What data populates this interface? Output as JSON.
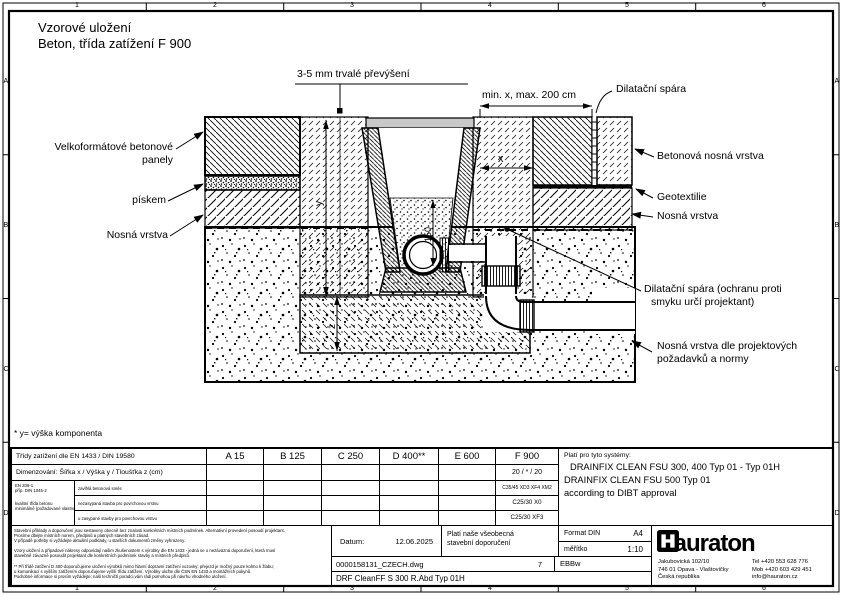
{
  "page": {
    "title_line1": "Vzorové uložení",
    "title_line2": "Beton, třída zatížení F 900",
    "footnote": "* y= výška komponenta"
  },
  "ruler": {
    "cols": [
      "1",
      "2",
      "3",
      "4",
      "5",
      "6"
    ],
    "rows": [
      "A",
      "B",
      "C",
      "D"
    ]
  },
  "drawing": {
    "annotations": {
      "overhang": "3-5 mm trvalé převýšení",
      "min_max": "min. x, max. 200 cm",
      "dilatation_top": "Dilatační spára",
      "panels_line1": "Velkoformátové betonové",
      "panels_line2": "panely",
      "sand": "pískem",
      "base_layer_left": "Nosná vrstva",
      "concrete_base": "Betonová nosná vrstva",
      "geotextile": "Geotextilie",
      "base_layer_right": "Nosná vrstva",
      "dilatation_lower_line1": "Dilatační spára (ochranu proti",
      "dilatation_lower_line2": "smyku určí projektant)",
      "base_req_line1": "Nosná vrstva dle projektových",
      "base_req_line2": "požadavků a normy",
      "dim_x": "x",
      "dim_y": "y",
      "dim_z": "z",
      "dim_150": "150"
    }
  },
  "table": {
    "load_class_row_label": "Třídy zatížení dle EN 1433 / DIN 19580",
    "load_classes": [
      "A 15",
      "B 125",
      "C 250",
      "D 400**",
      "E 600",
      "F 900"
    ],
    "dimension_row_label": "Dimenzování:  Šířka x / Výška y / Tloušťka z (cm)",
    "dimension_f900": "20 / * / 20",
    "standard_line1": "EN 206-1",
    "standard_line2": "příp. DIN 1045-2",
    "standard_line3": "kvalitní třída betonu",
    "standard_line4": "minimálně (požadované vlastnosti)",
    "concrete_rows": [
      {
        "label": "zavlhlá betonová směs",
        "f900": "C35/45 XD3 XF4 XM2"
      },
      {
        "label": "nezasypaná stavba pro povrchovou vrstvu",
        "f900": "C25/30 X0"
      },
      {
        "label": "u zasypané stavby pro povrchovou vrstvu",
        "f900": "C25/30 XF3"
      }
    ],
    "systems": {
      "heading": "Platí pro tyto systémy:",
      "line1": "DRAINFIX CLEAN FSU 300, 400 Typ 01 - Typ 01H",
      "line2": "DRAINFIX CLEAN FSU 500 Typ 01",
      "line3": "according to DIBT approval"
    }
  },
  "titleblock": {
    "disclaimer_lines": [
      "Stavební příklady a doporučení jsou sestaveny obecně bez znalosti konkrétních místních podmínek. Alternativní provedení posoudí projektant.",
      "Prosíme dbejte místních norem, předpisů a platných stavebních zásad.",
      "V případě potřeby si vyžádejte aktuální podklady, u starších dokumentů změny vyhrazeny.",
      "Vzory uložení a případové nákresy odpovídají našim zkušenostem s výrobky dle EN 1433 - jedná se o nezávazná doporučení, která musí",
      "stavebně závazně posoudit projektant dle konkrétních podmínek stavby a místních předpisů.",
      "** Při třídě zatížení D 400 doporučujeme uložení výrobků mimo hlavní dopravní zatížení vozovky; přejezd je možný pouze kolmo k žlabu;",
      "u komunikací s vyšším zatížením doporučujeme vyšší třídu zatížení. Výrobky uložte dle ČSN EN 1433 a montážních pokynů.",
      "Podrobné informace si prosím vyžádejte; naši techničtí poradci vám rádi pomohou při návrhu vhodného uložení."
    ],
    "date_label": "Datum:",
    "date_value": "12.06.2025",
    "note_line1": "Platí naše všeobecná",
    "note_line2": "stavební doporučení",
    "format_label": "Format DIN",
    "format_value": "A4",
    "scale_label": "měřítko",
    "scale_value": "1:10",
    "file_name": "0000158131_CZECH.dwg",
    "sheet_number": "7",
    "code": "EBBw",
    "drawing_title": "DRF CleanFF S 300 R.Abd Typ 01H",
    "company": {
      "logo_text": "hauraton",
      "address_line1": "Jakubovická 102/10",
      "address_line2": "746 01 Opava - Vlaštovičky",
      "address_line3": "Česká republika",
      "tel": "Tel +420 553 628 776",
      "mob": "Mob +420 603 429 451",
      "email": "info@hauraton.cz"
    }
  },
  "colors": {
    "ink": "#000000",
    "paper": "#ffffff",
    "cover_gray": "#c8c8c8"
  }
}
